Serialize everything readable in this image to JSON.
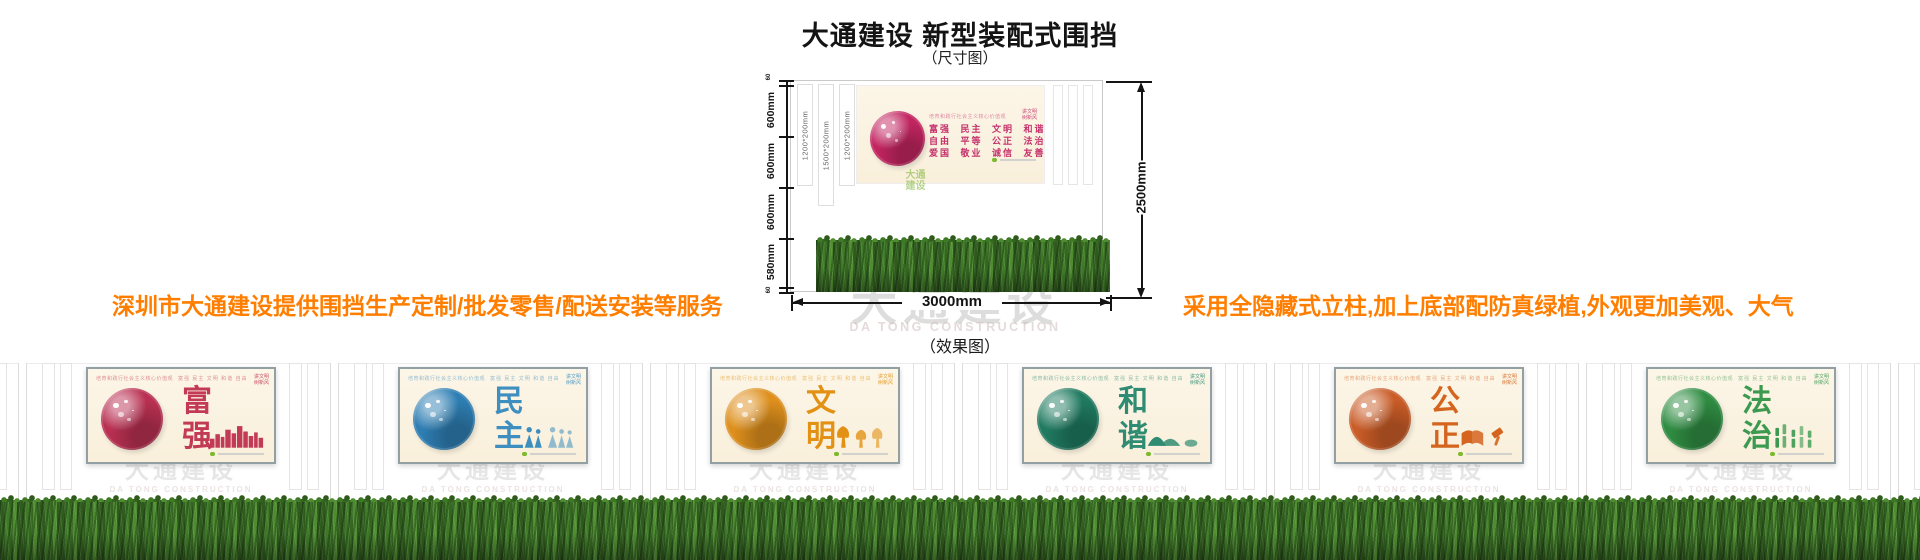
{
  "page": {
    "title": "大通建设 新型装配式围挡",
    "dimension_label": "（尺寸图）",
    "effect_label": "（效果图）"
  },
  "promo": {
    "left": "深圳市大通建设提供围挡生产定制/批发零售/配送安装等服务",
    "right": "采用全隐藏式立柱,加上底部配防真绿植,外观更加美观、大气",
    "color": "#FF7E00"
  },
  "dimensions": {
    "left_segments": [
      "60",
      "600mm",
      "600mm",
      "600mm",
      "580mm",
      "60"
    ],
    "post_sizes": [
      "1200*200mm",
      "1500*200mm",
      "1200*200mm"
    ],
    "total_height": "2500mm",
    "total_width": "3000mm"
  },
  "values_design": {
    "header": "培育和践行社会主义核心价值观",
    "badge_line1": "讲文明",
    "badge_line2": "树新风",
    "rows": [
      "富强 民主 文明 和谐",
      "自由 平等 公正 法治",
      "爱国 敬业 诚信 友善"
    ],
    "inline": "富强 民主 文明 和谐 自由 平等 公正 法治 爱国 敬业 诚信 友善",
    "accent": "#C5326B",
    "circle_color": "#C22560",
    "panel_bg": "#FBF3E4"
  },
  "watermark": {
    "cn": "大通建设",
    "en": "DA TONG CONSTRUCTION"
  },
  "logo_text": "大通建设",
  "panels": [
    {
      "word": "富强",
      "color": "#C23A55",
      "circle": "#B93052",
      "motif": "city-skyline"
    },
    {
      "word": "民主",
      "color": "#3E8FC0",
      "circle": "#2E7EB3",
      "motif": "people"
    },
    {
      "word": "文明",
      "color": "#E39114",
      "circle": "#DE8F1C",
      "motif": "trees"
    },
    {
      "word": "和谐",
      "color": "#2F8C72",
      "circle": "#1F7A60",
      "motif": "mountains"
    },
    {
      "word": "公正",
      "color": "#D4641E",
      "circle": "#C95C27",
      "motif": "book-gavel"
    },
    {
      "word": "法治",
      "color": "#3C9A50",
      "circle": "#2F8C42",
      "motif": "bamboo"
    }
  ],
  "palette": {
    "grass_dark": "#2E5A1C",
    "grass_mid": "#3E7A26",
    "grass_light": "#4E8C30",
    "frame": "#93A0A3",
    "orange": "#FF7E00"
  }
}
